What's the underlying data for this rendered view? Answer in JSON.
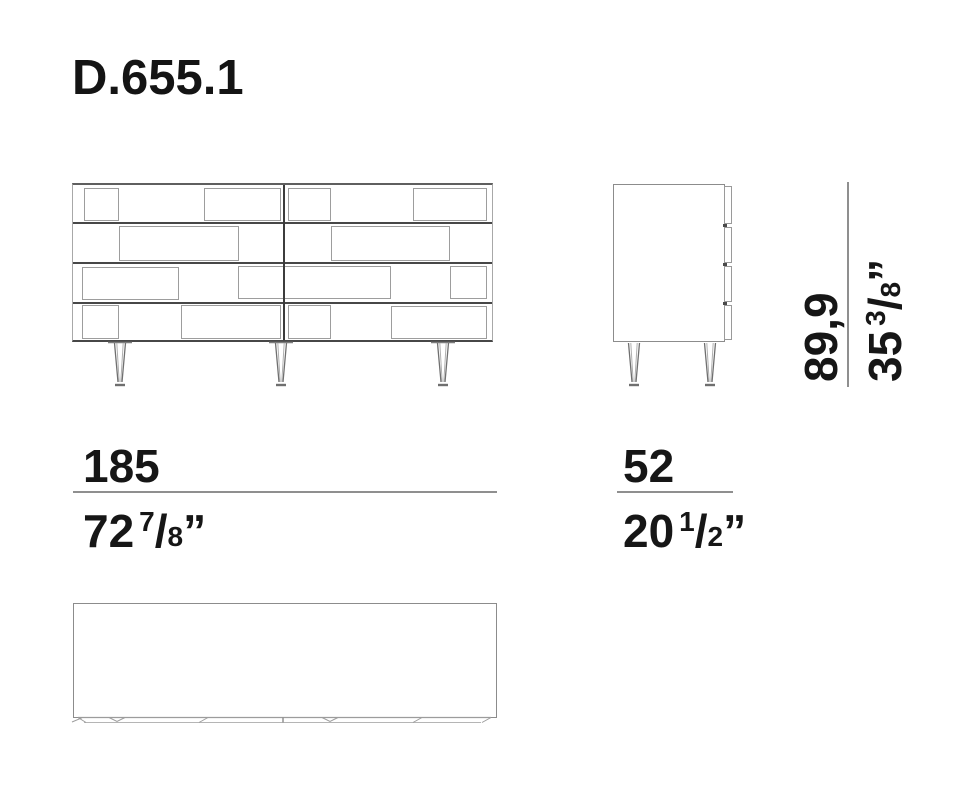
{
  "title": "D.655.1",
  "dimensions": {
    "fraction_slash": "/",
    "inch_mark": "”",
    "width": {
      "metric": "185",
      "imperial_whole": "72",
      "imperial_num": "7",
      "imperial_den": "8"
    },
    "depth": {
      "metric": "52",
      "imperial_whole": "20",
      "imperial_num": "1",
      "imperial_den": "2"
    },
    "height": {
      "metric": "89,9",
      "imperial_whole": "35",
      "imperial_num": "3",
      "imperial_den": "8"
    }
  },
  "colors": {
    "background": "#ffffff",
    "line_dark": "#3c3c3c",
    "line_medium": "#8c8c8c",
    "line_light": "#9d9d9d",
    "text": "#161616"
  }
}
